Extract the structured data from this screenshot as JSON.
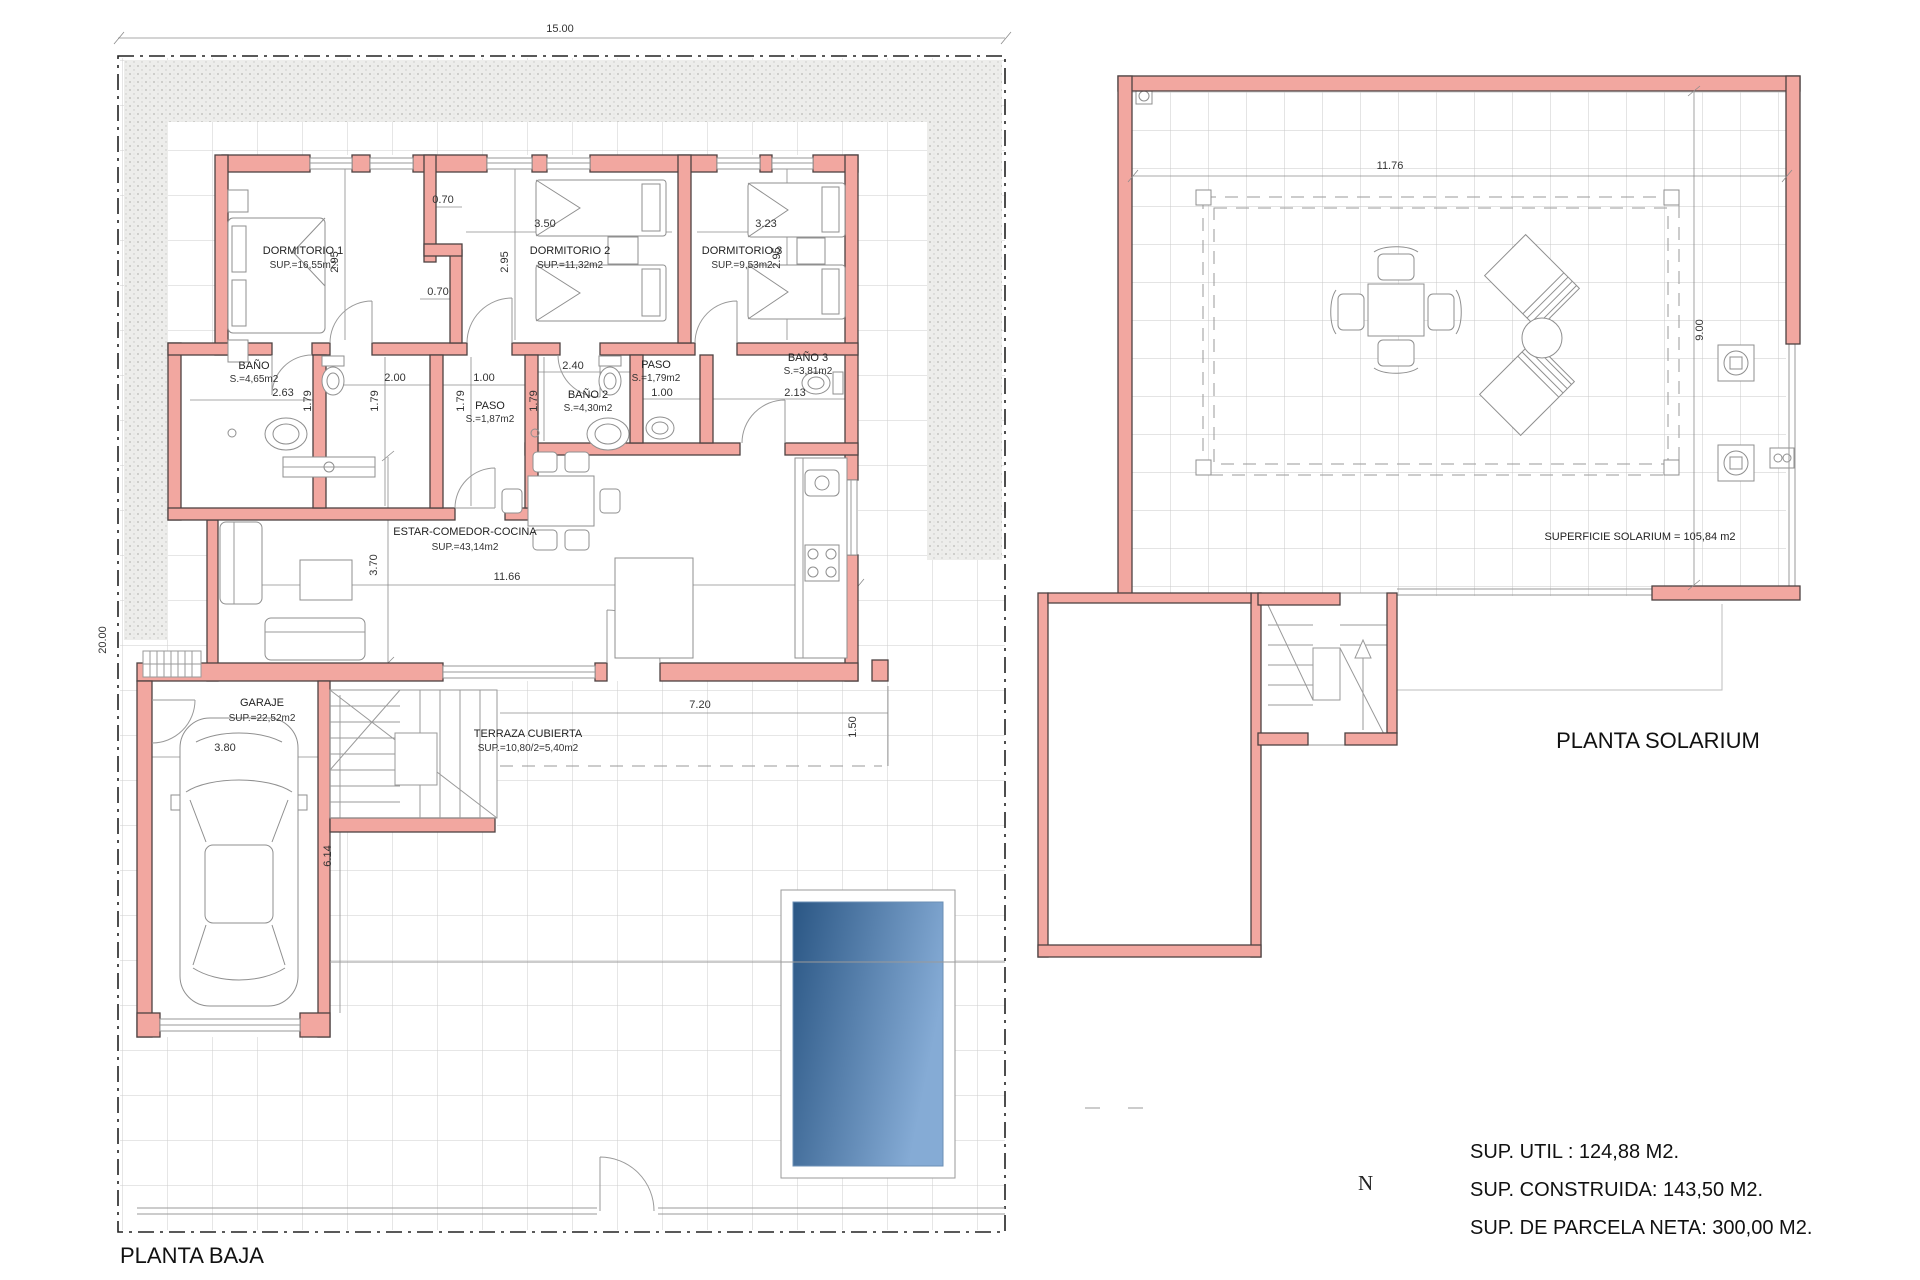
{
  "plan_baja": {
    "title": "PLANTA BAJA",
    "rooms": {
      "dorm1": {
        "name": "DORMITORIO 1",
        "area": "SUP.=16,55m2"
      },
      "dorm2": {
        "name": "DORMITORIO 2",
        "area": "SUP.=11,32m2"
      },
      "dorm3": {
        "name": "DORMITORIO 3",
        "area": "SUP.=9,53m2"
      },
      "bano1": {
        "name": "BAÑO",
        "area": "S.=4,65m2"
      },
      "paso1": {
        "name": "PASO",
        "area": "S.=1,87m2"
      },
      "bano2": {
        "name": "BAÑO 2",
        "area": "S.=4,30m2"
      },
      "paso2": {
        "name": "PASO",
        "area": "S.=1,79m2"
      },
      "bano3": {
        "name": "BAÑO 3",
        "area": "S.=3,81m2"
      },
      "estar": {
        "name": "ESTAR-COMEDOR-COCINA",
        "area": "SUP.=43,14m2"
      },
      "garaje": {
        "name": "GARAJE",
        "area": "SUP.=22,52m2"
      },
      "terraza": {
        "name": "TERRAZA CUBIERTA",
        "area": "SUP.=10,80/2=5,40m2"
      }
    },
    "dims": {
      "parcel_width": "15.00",
      "parcel_depth": "20.00",
      "armario_top": "0.70",
      "armario_bottom": "0.70",
      "dorm1_depth": "2.95",
      "dorm2_depth": "2.95",
      "dorm3_depth": "2.95",
      "dorm2_width": "3.50",
      "dorm3_width": "3.23",
      "bano1_width": "2.63",
      "lavadero_width": "2.00",
      "paso1_door": "1.00",
      "bano2_width": "2.40",
      "paso2_door": "1.00",
      "bano3_width": "2.13",
      "band1": "1.79",
      "band2": "1.79",
      "band3": "1.79",
      "band4": "1.79",
      "estar_depth": "3.70",
      "estar_width": "11.66",
      "garaje_width": "3.80",
      "garaje_depth": "6.14",
      "terraza_width": "7.20",
      "terraza_depth": "1.50"
    }
  },
  "plan_solarium": {
    "title": "PLANTA SOLARIUM",
    "surface_label": "SUPERFICIE SOLARIUM = 105,84 m2",
    "dims": {
      "width": "11.76",
      "depth": "9.00"
    }
  },
  "summary": {
    "util": "SUP. UTIL : 124,88 M2.",
    "construida": "SUP. CONSTRUIDA: 143,50 M2.",
    "parcela": "SUP. DE PARCELA NETA: 300,00 M2."
  },
  "compass": {
    "north": "N"
  },
  "colors": {
    "wall_fill": "#f2a7a0",
    "pool_dark": "#2a5684",
    "pool_light": "#85abd5"
  }
}
